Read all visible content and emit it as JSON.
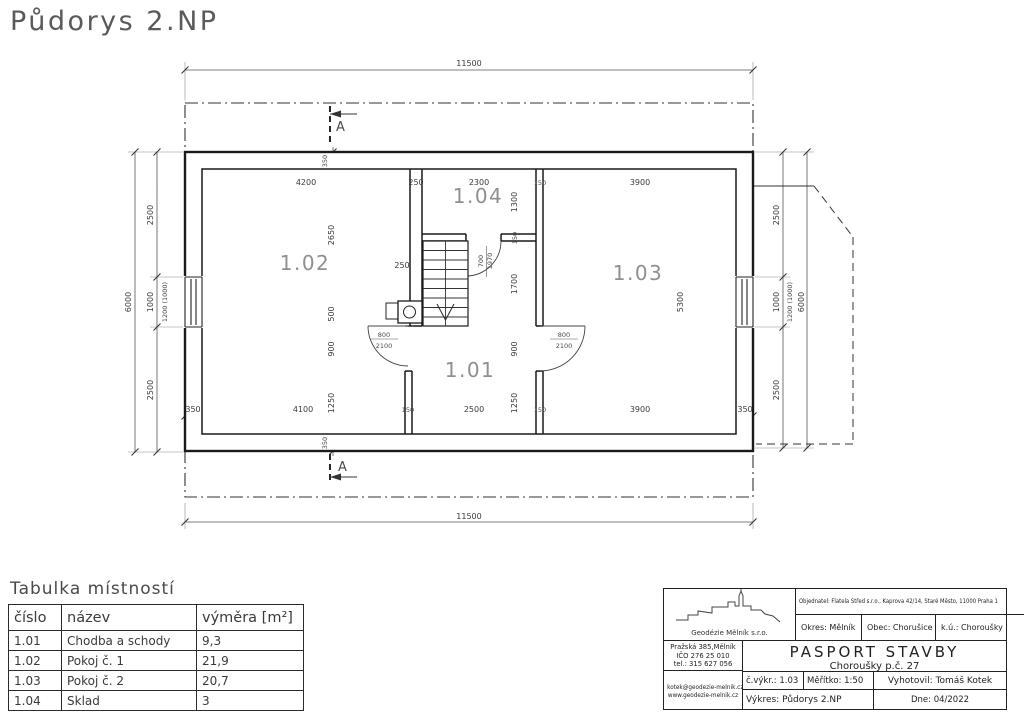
{
  "page": {
    "title": "Půdorys 2.NP"
  },
  "plan": {
    "labels": {
      "room_101": "1.01",
      "room_102": "1.02",
      "room_103": "1.03",
      "room_104": "1.04",
      "section": "A"
    },
    "dims": {
      "overall": "11500",
      "total_height": "6000",
      "side_2500": "2500",
      "side_1000": "1000",
      "window_note": "1200 (1000)",
      "top_4200": "4200",
      "top_250": "250",
      "top_2300": "2300",
      "top_150": "150",
      "top_3900": "3900",
      "bot_350": "350",
      "bot_4100": "4100",
      "bot_150": "150",
      "bot_2500": "2500",
      "bot_3900": "3900",
      "v_2650": "2650",
      "v_500": "500",
      "v_900": "900",
      "v_1250": "1250",
      "v_1300": "1300",
      "v_150": "150",
      "v_1700": "1700",
      "v_5300": "5300",
      "wall_350": "350",
      "stair_250": "250",
      "door_800": "800",
      "door_2100": "2100",
      "door_700": "700",
      "door_1970": "1970"
    }
  },
  "room_table": {
    "title": "Tabulka místností",
    "headers": [
      "číslo",
      "název",
      "výměra [m²]"
    ],
    "rows": [
      [
        "1.01",
        "Chodba a schody",
        "9,3"
      ],
      [
        "1.02",
        "Pokoj č. 1",
        "21,9"
      ],
      [
        "1.03",
        "Pokoj č. 2",
        "20,7"
      ],
      [
        "1.04",
        "Sklad",
        "3"
      ]
    ]
  },
  "title_block": {
    "company": "Geodézie Mělník s.r.o.",
    "address_line1": "Pražská 385,Mělník",
    "address_line2": "IČO 276 25 010",
    "address_line3": "tel.: 315 627 056",
    "email": "kotek@geodezie-melnik.cz",
    "web": "www.geodezie-melnik.cz",
    "client": "Objednatel: Flatela Střed s.r.o., Kaprova 42/14, Staré Město, 11000 Praha 1",
    "district": "Okres: Mělník",
    "municipality": "Obec: Chorušice",
    "cadastre": "k.ú.: Choroušky",
    "project_title": "PASPORT STAVBY",
    "project_subtitle": "Choroušky p.č. 27",
    "drawing_no": "č.výkr.: 1.03",
    "scale": "Měřítko: 1:50",
    "author": "Vyhotovil: Tomáš Kotek",
    "drawing_name": "Výkres: Půdorys 2.NP",
    "date": "Dne: 04/2022"
  }
}
